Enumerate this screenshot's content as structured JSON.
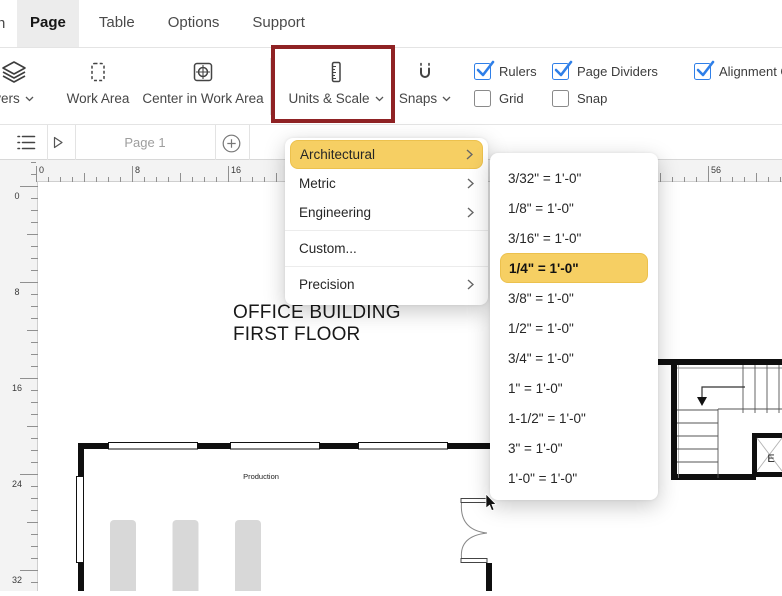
{
  "menu_bar": {
    "clipped_item": "n",
    "items": [
      {
        "label": "Page",
        "active": true
      },
      {
        "label": "Table",
        "active": false
      },
      {
        "label": "Options",
        "active": false
      },
      {
        "label": "Support",
        "active": false
      }
    ]
  },
  "toolbar": {
    "buttons": [
      {
        "label": "yers",
        "icon": "layers-icon",
        "dropdown": true
      },
      {
        "label": "Work Area",
        "icon": "work-area-icon",
        "dropdown": false
      },
      {
        "label": "Center in Work Area",
        "icon": "center-in-work-area-icon",
        "dropdown": false
      },
      {
        "label": "Units & Scale",
        "icon": "units-scale-icon",
        "dropdown": true,
        "highlighted": true
      },
      {
        "label": "Snaps",
        "icon": "magnet-icon",
        "dropdown": true
      }
    ],
    "checkboxes": [
      {
        "label": "Rulers",
        "checked": true
      },
      {
        "label": "Grid",
        "checked": false
      },
      {
        "label": "Page Dividers",
        "checked": true
      },
      {
        "label": "Snap",
        "checked": false
      },
      {
        "label": "Alignment Gu",
        "checked": true
      }
    ],
    "highlight_box_color": "#8f2224",
    "checkbox_accent": "#2f7fe8"
  },
  "page_bar": {
    "page_tab_label": "Page 1"
  },
  "rulers": {
    "horizontal_labels": [
      "0",
      "8",
      "16",
      "56"
    ],
    "vertical_labels": [
      "0",
      "8",
      "16",
      "24",
      "32"
    ]
  },
  "units_menu": {
    "highlight_color": "#f6cf63",
    "items": [
      {
        "label": "Architectural",
        "selected": true,
        "has_submenu": true,
        "divider_after": false
      },
      {
        "label": "Metric",
        "selected": false,
        "has_submenu": true,
        "divider_after": false
      },
      {
        "label": "Engineering",
        "selected": false,
        "has_submenu": true,
        "divider_after": true
      },
      {
        "label": "Custom...",
        "selected": false,
        "has_submenu": false,
        "divider_after": true
      },
      {
        "label": "Precision",
        "selected": false,
        "has_submenu": true,
        "divider_after": false
      }
    ]
  },
  "scale_submenu": {
    "items": [
      {
        "label": "3/32\" = 1'-0\"",
        "selected": false
      },
      {
        "label": "1/8\" = 1'-0\"",
        "selected": false
      },
      {
        "label": "3/16\" = 1'-0\"",
        "selected": false
      },
      {
        "label": "1/4\" = 1'-0\"",
        "selected": true
      },
      {
        "label": "3/8\" = 1'-0\"",
        "selected": false
      },
      {
        "label": "1/2\" = 1'-0\"",
        "selected": false
      },
      {
        "label": "3/4\" = 1'-0\"",
        "selected": false
      },
      {
        "label": "1\" = 1'-0\"",
        "selected": false
      },
      {
        "label": "1-1/2\" = 1'-0\"",
        "selected": false
      },
      {
        "label": "3\" = 1'-0\"",
        "selected": false
      },
      {
        "label": "1'-0\" = 1'-0\"",
        "selected": false
      }
    ]
  },
  "canvas": {
    "title_line1": "OFFICE BUILDING",
    "title_line2": "FIRST FLOOR",
    "room_label": "Production",
    "elevator_label": "E"
  }
}
